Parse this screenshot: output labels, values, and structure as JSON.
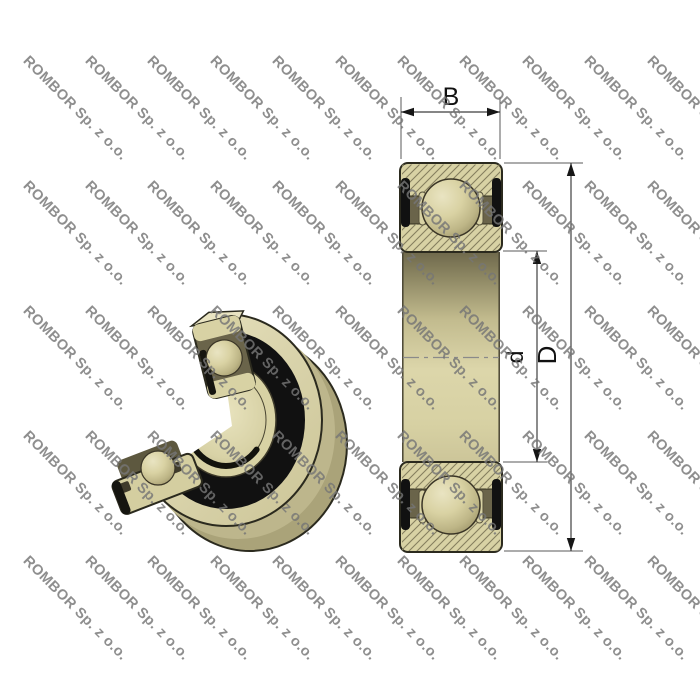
{
  "watermark": {
    "text": "ROMBOR Sp. z o.o."
  },
  "drawing": {
    "type": "bearing-technical-drawing",
    "labels": {
      "width": "B",
      "bore_diameter": "d",
      "outer_diameter": "D"
    }
  },
  "colors": {
    "cream": "#d8d2a4",
    "cream_light": "#e9e4c2",
    "cream_dark": "#aaa379",
    "olive_dark": "#6a644a",
    "seal_black": "#111111",
    "outline": "#2b2a1e",
    "hatch_line": "#857f5e",
    "dim_line": "#5a5a5a",
    "label_ink": "#111111",
    "watermark_gray": "#767676"
  }
}
